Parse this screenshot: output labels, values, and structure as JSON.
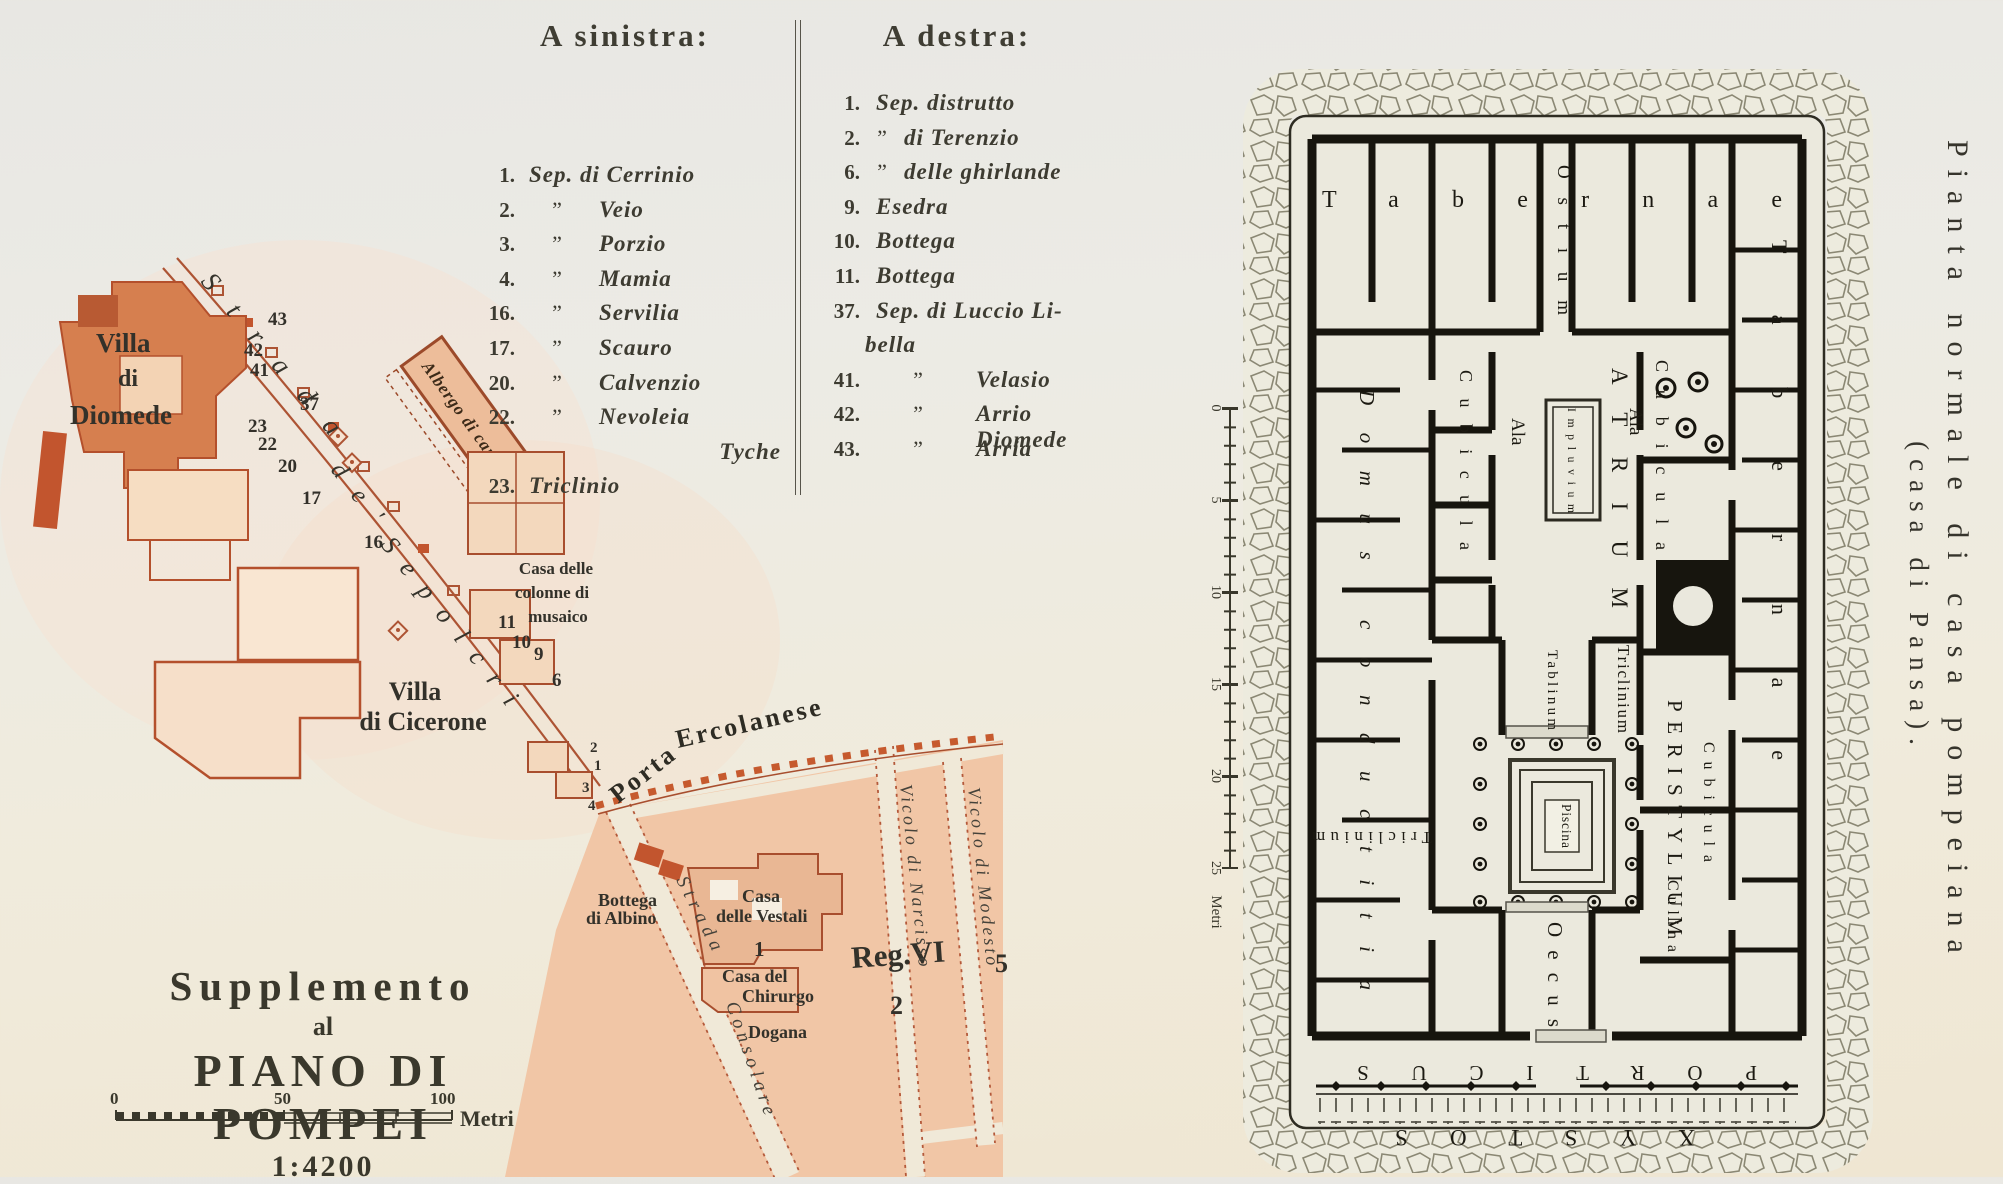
{
  "legend": {
    "left": {
      "heading": "A sinistra:",
      "items": [
        {
          "n": "1.",
          "d": "",
          "t": "Sep. di Cerrinio"
        },
        {
          "n": "2.",
          "d": "”",
          "t": "Veio"
        },
        {
          "n": "3.",
          "d": "”",
          "t": "Porzio"
        },
        {
          "n": "4.",
          "d": "”",
          "t": "Mamia"
        },
        {
          "n": "16.",
          "d": "”",
          "t": "Servilia"
        },
        {
          "n": "17.",
          "d": "”",
          "t": "Scauro"
        },
        {
          "n": "20.",
          "d": "”",
          "t": "Calvenzio"
        },
        {
          "n": "22.",
          "d": "”",
          "t": "Nevoleia"
        },
        {
          "n": "",
          "d": "",
          "t": "Tyche"
        },
        {
          "n": "23.",
          "d": "",
          "t": "Triclinio"
        }
      ]
    },
    "right": {
      "heading": "A destra:",
      "items": [
        {
          "n": "1.",
          "d": "",
          "t": "Sep. distrutto"
        },
        {
          "n": "2.",
          "d": "”",
          "t": "di Terenzio"
        },
        {
          "n": "6.",
          "d": "”",
          "t": "delle ghirlande"
        },
        {
          "n": "9.",
          "d": "",
          "t": "Esedra"
        },
        {
          "n": "10.",
          "d": "",
          "t": "Bottega"
        },
        {
          "n": "11.",
          "d": "",
          "t": "Bottega"
        },
        {
          "n": "37.",
          "d": "",
          "t": "Sep. di Luccio Li-"
        },
        {
          "n": "",
          "d": "",
          "t": "bella"
        },
        {
          "n": "41.",
          "d": "”",
          "t": "Velasio"
        },
        {
          "n": "42.",
          "d": "”",
          "t": "Arrio Diomede"
        },
        {
          "n": "43.",
          "d": "”",
          "t": "Arria"
        }
      ]
    }
  },
  "title_block": {
    "l1": "Supplemento",
    "l2": "al",
    "l3": "PIANO DI POMPEI",
    "l4": "1:4200",
    "scale": {
      "t0": "0",
      "t50": "50",
      "t100": "100",
      "unit": "Metri"
    }
  },
  "caption": {
    "line1": "Pianta normale di casa pompeiana",
    "line2": "(casa di Pansa)."
  },
  "map": {
    "villa_diomede": {
      "l1": "Villa",
      "l2": "di",
      "l3": "Diomede"
    },
    "strada_sepolcri": {
      "w1": "Strada",
      "w2": "de'",
      "w3": "Sepolcri"
    },
    "albergo": "Albergo di campagna",
    "casa_colonne": {
      "l1": "Casa delle",
      "l2": "colonne di",
      "l3": "musaico"
    },
    "villa_cicerone": {
      "l1": "Villa",
      "l2": "di Cicerone"
    },
    "porta": {
      "w1": "Porta",
      "w2": "Ercolanese"
    },
    "bottega_albino": {
      "l1": "Bottega",
      "l2": "di Albino"
    },
    "casa_vestali": {
      "l1": "Casa",
      "l2": "delle Vestali"
    },
    "casa_chirurgo": {
      "l1": "Casa del",
      "l2": "Chirurgo"
    },
    "dogana": "Dogana",
    "reg": {
      "name": "Reg.VI",
      "n5": "5",
      "n2": "2"
    },
    "strada_consolare": {
      "w1": "Strada",
      "w2": "Consolare"
    },
    "vicolo_narcisso": "Vicolo di Narcisso",
    "vicolo_modesto": "Vicolo di Modesto",
    "nums": {
      "n43": "43",
      "n42": "42",
      "n41": "41",
      "n37": "37",
      "n23": "23",
      "n22": "22",
      "n20": "20",
      "n17": "17",
      "n16": "16",
      "n11": "11",
      "n10": "10",
      "n9": "9",
      "n6": "6",
      "n4": "4",
      "n3": "3",
      "n2": "2",
      "n1": "1",
      "v1": "1"
    }
  },
  "plan": {
    "tabernae_top": "Tabernae",
    "ostium": "Ostium",
    "atrium": "ATRIUM",
    "impluvium": "Impluvium",
    "cubicula_left": "Cubicula",
    "cubicula_right": "Cubicula",
    "ala_left": "Ala",
    "ala_right": "Ala",
    "tablinum": "Tablinum",
    "triclinium_right": "Triclinium",
    "domus": "Domus conductitia",
    "peristylium": "PERISTYLIUM",
    "piscina": "Piscina",
    "cubicula_se": "Cubicula",
    "tabernae_right": "Tabernae",
    "triclinium_bottom": "Triclinium",
    "oecus": "Oecus",
    "culina": "Culina",
    "porticus": "PORTICUS",
    "xystos": "XYSTOS",
    "scale": {
      "t0": "0",
      "t5": "5",
      "t10": "10",
      "t15": "15",
      "t20": "20",
      "t25": "25",
      "unit": "Metri"
    }
  },
  "palette": {
    "city_fill": "#f1c6a6",
    "building": "#d0744a",
    "map_line": "#ad5434",
    "wall_dash": "#c65a2e",
    "ink": "#33312a",
    "plan_ink": "#17150e",
    "paper": "#ebe9dd"
  }
}
